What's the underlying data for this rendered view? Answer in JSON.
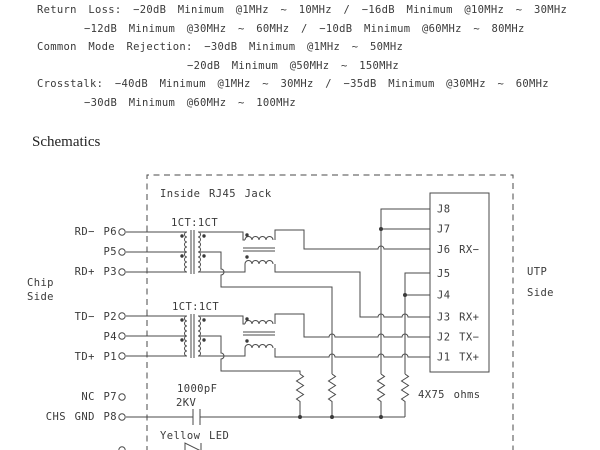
{
  "specs": {
    "return_loss_1": "Return Loss: −20dB Minimum @1MHz ~ 10MHz / −16dB Minimum @10MHz ~ 30MHz",
    "return_loss_2": "−12dB Minimum @30MHz ~ 60MHz / −10dB Minimum @60MHz ~ 80MHz",
    "common_mode_1": "Common Mode Rejection: −30dB Minimum @1MHz ~ 50MHz",
    "common_mode_2": "−20dB Minimum @50MHz ~ 150MHz",
    "crosstalk_1": "Crosstalk: −40dB Minimum @1MHz ~ 30MHz / −35dB Minimum @30MHz ~ 60MHz",
    "crosstalk_2": "−30dB Minimum @60MHz ~ 100MHz"
  },
  "heading": "Schematics",
  "schematic": {
    "boundary_label": "Inside RJ45 Jack",
    "chip_side_1": "Chip",
    "chip_side_2": "Side",
    "utp_side_1": "UTP",
    "utp_side_2": "Side",
    "rx_transformer_ratio": "1CT:1CT",
    "tx_transformer_ratio": "1CT:1CT",
    "capacitor_value": "1000pF",
    "capacitor_rating": "2KV",
    "led_label": "Yellow LED",
    "resistors_label": "4X75 ohms",
    "chip_pins": [
      {
        "label": "RD− P6"
      },
      {
        "label": "P5"
      },
      {
        "label": "RD+ P3"
      },
      {
        "label": "TD− P2"
      },
      {
        "label": "P4"
      },
      {
        "label": "TD+ P1"
      },
      {
        "label": "NC P7"
      },
      {
        "label": "CHS GND P8"
      }
    ],
    "jack_pins": [
      {
        "label": "J8"
      },
      {
        "label": "J7"
      },
      {
        "label": "J6 RX−"
      },
      {
        "label": "J5"
      },
      {
        "label": "J4"
      },
      {
        "label": "J3 RX+"
      },
      {
        "label": "J2 TX−"
      },
      {
        "label": "J1 TX+"
      }
    ]
  }
}
